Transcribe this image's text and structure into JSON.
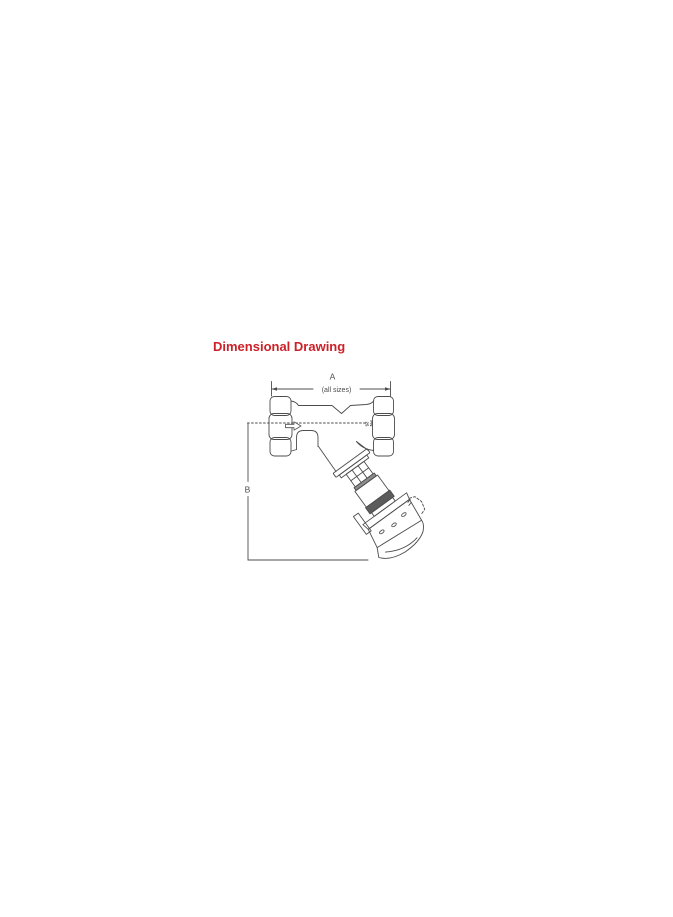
{
  "page": {
    "background_color": "#ffffff"
  },
  "title": {
    "text": "Dimensional Drawing",
    "color": "#cc2129"
  },
  "figure": {
    "line_color": "#4d4d4d",
    "dim_a": {
      "label": "A",
      "note": "(all sizes)"
    },
    "dim_b": {
      "label": "B"
    },
    "pn_rating": {
      "line1": "PN",
      "line2": "25"
    },
    "flow_arrow_icon": "flow-direction-right-arrow"
  }
}
